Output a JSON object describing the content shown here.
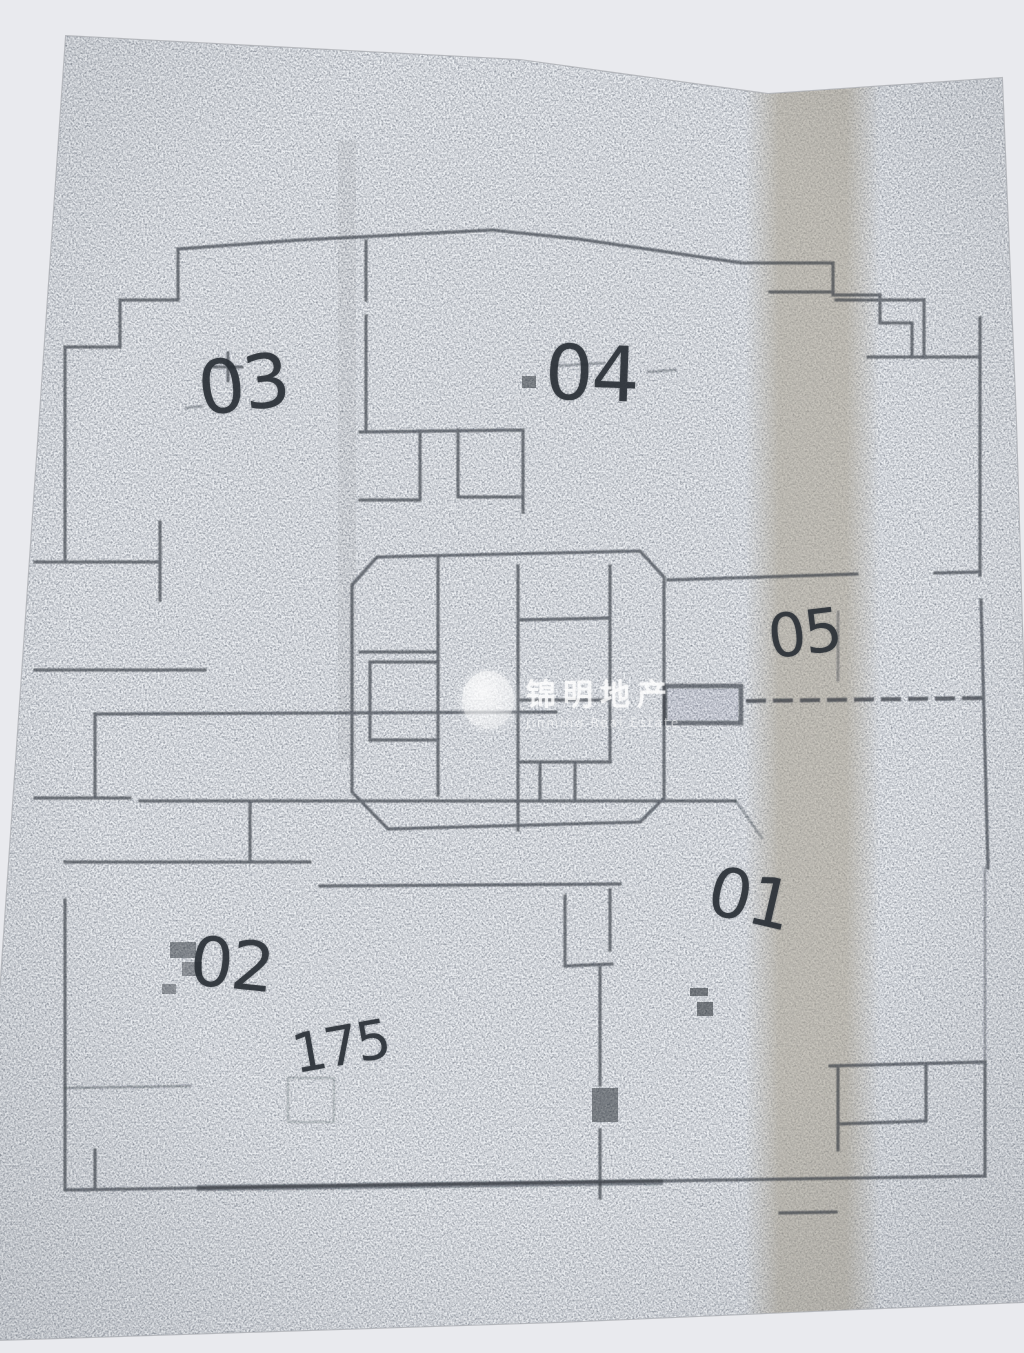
{
  "scene": {
    "background_color": "#e9eaee",
    "paper_color": "#a2a8b0",
    "warm_band_color": "#a8a08f",
    "ink_color": "#2e343b"
  },
  "floor_plan": {
    "labels": {
      "u03": {
        "text": "03"
      },
      "u04": {
        "text": "04"
      },
      "u05": {
        "text": "05"
      },
      "u01": {
        "text": "01"
      },
      "u02": {
        "text": "02"
      },
      "area_note": {
        "text": "175"
      }
    },
    "watermark": {
      "cn": "锦明地产",
      "en": "Jinming Real Estate"
    }
  }
}
